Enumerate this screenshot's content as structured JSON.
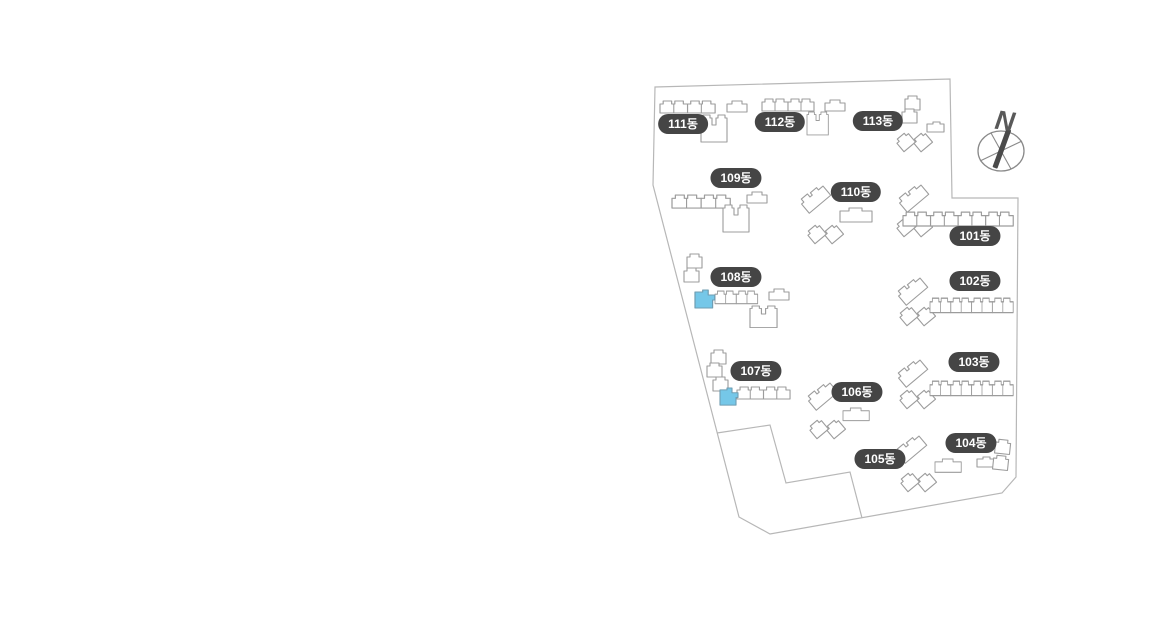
{
  "site_map": {
    "compass": {
      "label": "N"
    },
    "buildings": [
      {
        "id": "101",
        "label": "101동"
      },
      {
        "id": "102",
        "label": "102동"
      },
      {
        "id": "103",
        "label": "103동"
      },
      {
        "id": "104",
        "label": "104동"
      },
      {
        "id": "105",
        "label": "105동"
      },
      {
        "id": "106",
        "label": "106동"
      },
      {
        "id": "107",
        "label": "107동"
      },
      {
        "id": "108",
        "label": "108동"
      },
      {
        "id": "109",
        "label": "109동"
      },
      {
        "id": "110",
        "label": "110동"
      },
      {
        "id": "111",
        "label": "111동"
      },
      {
        "id": "112",
        "label": "112동"
      },
      {
        "id": "113",
        "label": "113동"
      }
    ],
    "highlighted_units": {
      "dongs": [
        "107동",
        "108동"
      ],
      "meaning": "selected-units"
    },
    "colors": {
      "label_bg": "#454545",
      "label_text": "#ffffff",
      "building_fill": "#ffffff",
      "building_outline": "#9c9c9c",
      "boundary_line": "#b7b7b7",
      "highlight_fill": "#75c7e8",
      "highlight_outline": "#6f9db2",
      "compass_color": "#8a8a8a",
      "needle_color": "#4a4a4a"
    }
  }
}
